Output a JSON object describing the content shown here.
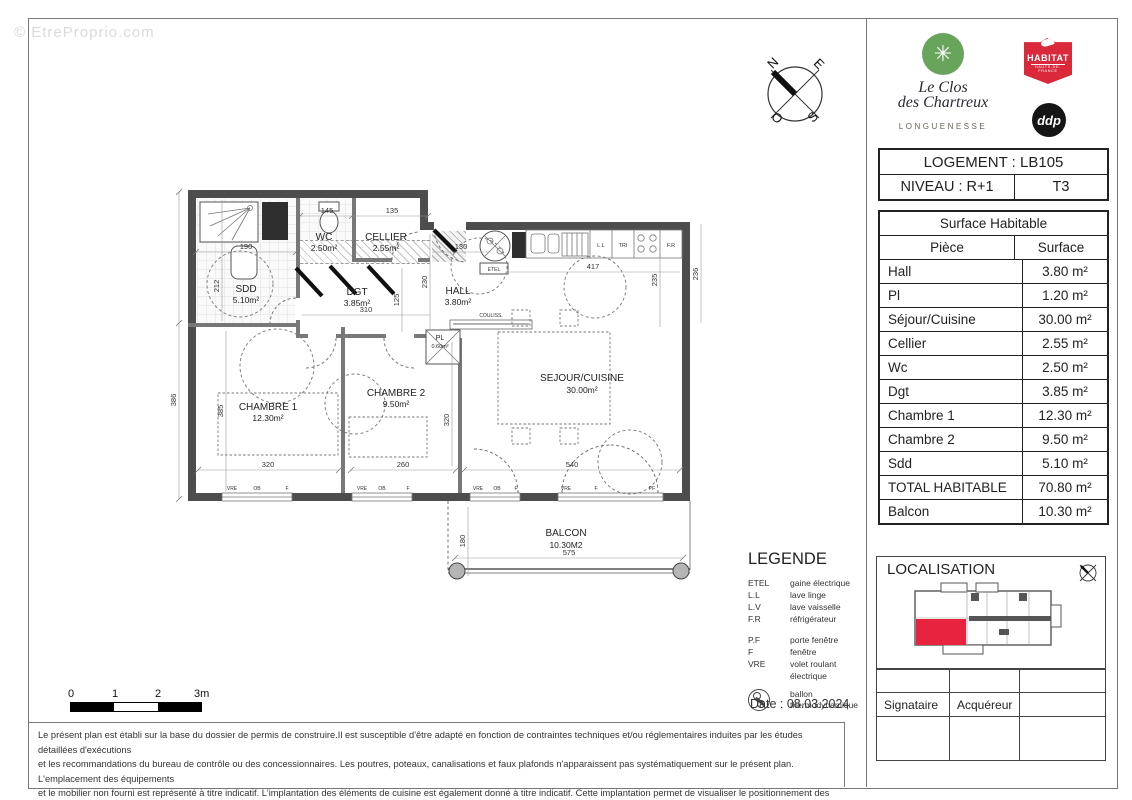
{
  "watermark": "© EtreProprio.com",
  "branding": {
    "project_name_line1": "Le Clos",
    "project_name_line2": "des Chartreux",
    "city": "LONGUENESSE",
    "logo_flower_glyph": "✳",
    "habitat_logo_text": "HABITAT",
    "habitat_logo_subtext": "HAUTS-DE-FRANCE",
    "ddp_logo_text": "ddp",
    "brand_green": "#69a45c",
    "brand_red": "#d9293b"
  },
  "compass": {
    "n": "N",
    "e": "E",
    "o": "O",
    "s": "S"
  },
  "unit_info": {
    "logement_label": "LOGEMENT : LB105",
    "niveau_label": "NIVEAU : R+1",
    "type_label": "T3"
  },
  "surface_table": {
    "title": "Surface Habitable",
    "col_piece": "Pièce",
    "col_surface": "Surface",
    "rows": [
      {
        "piece": "Hall",
        "surface": "3.80 m²"
      },
      {
        "piece": "Pl",
        "surface": "1.20 m²"
      },
      {
        "piece": "Séjour/Cuisine",
        "surface": "30.00 m²"
      },
      {
        "piece": "Cellier",
        "surface": "2.55 m²"
      },
      {
        "piece": "Wc",
        "surface": "2.50 m²"
      },
      {
        "piece": "Dgt",
        "surface": "3.85 m²"
      },
      {
        "piece": "Chambre 1",
        "surface": "12.30 m²"
      },
      {
        "piece": "Chambre 2",
        "surface": "9.50 m²"
      },
      {
        "piece": "Sdd",
        "surface": "5.10 m²"
      },
      {
        "piece": "TOTAL HABITABLE",
        "surface": "70.80 m²"
      },
      {
        "piece": "Balcon",
        "surface": "10.30 m²"
      }
    ]
  },
  "plan": {
    "rooms": [
      {
        "name": "SDD",
        "area": "5.10m²"
      },
      {
        "name": "WC",
        "area": "2.50m²"
      },
      {
        "name": "CELLIER",
        "area": "2.55m²"
      },
      {
        "name": "DGT",
        "area": "3.85m²"
      },
      {
        "name": "HALL",
        "area": "3.80m²"
      },
      {
        "name": "PL",
        "area": "0.60m²"
      },
      {
        "name": "CHAMBRE 1",
        "area": "12.30m²"
      },
      {
        "name": "CHAMBRE 2",
        "area": "9.50m²"
      },
      {
        "name": "SEJOUR/CUISINE",
        "area": "30.00m²"
      },
      {
        "name": "BALCON",
        "area": "10.30M2"
      }
    ],
    "dims": [
      "190",
      "212",
      "145",
      "135",
      "130",
      "417",
      "310",
      "230",
      "125",
      "386",
      "385",
      "320",
      "260",
      "320",
      "540",
      "235",
      "236",
      "575",
      "180"
    ],
    "appliances": [
      "L.L",
      "TRI",
      "F.R"
    ],
    "annotations": {
      "etel": "ETEL",
      "couliss": "COULISS."
    },
    "window_labels": [
      "VRE",
      "OB",
      "F",
      "VRE",
      "OB",
      "F",
      "VRE",
      "OB",
      "F",
      "VRE",
      "F",
      "PF"
    ]
  },
  "legend": {
    "title": "LEGENDE",
    "items": [
      {
        "abbr": "ETEL",
        "label": "gaine électrique"
      },
      {
        "abbr": "L.L",
        "label": "lave linge"
      },
      {
        "abbr": "L.V",
        "label": "lave vaisselle"
      },
      {
        "abbr": "F.R",
        "label": "réfrigérateur"
      },
      {
        "abbr": "P.F",
        "label": "porte fenêtre"
      },
      {
        "abbr": "F",
        "label": "fenêtre"
      },
      {
        "abbr": "VRE",
        "label": "volet roulant électrique"
      }
    ],
    "ballon_label": "ballon thermodynamique"
  },
  "localisation": {
    "title": "LOCALISATION",
    "unit_color": "#e8233f"
  },
  "scalebar": {
    "labels": [
      "0",
      "1",
      "2",
      "3m"
    ]
  },
  "date_label": "Date : 08.03.2024",
  "signature": {
    "signataire": "Signataire",
    "acquereur": "Acquéreur"
  },
  "disclaimer": {
    "lines": [
      "Le présent plan est établi sur la base du dossier de permis de construire.Il est susceptible d'être adapté en fonction de contraintes techniques et/ou réglementaires induites par les études détaillées d'exécutions",
      "et les recommandations du bureau de contrôle ou des concessionnaires. Les poutres, poteaux, canalisations et faux plafonds n'apparaissent pas systématiquement sur le présent plan. L'emplacement des équipements",
      "et le mobilier non fourni est représenté à titre indicatif. L'implantation des éléments de cuisine est également donné à titre indicatif. Cette implantation permet de visualiser le positionnement des points électriques,",
      "des arrivées et des évacuations d'eau à la livraison du logement. Les balcons, terrasses, loggias et jardins sont à jouissance privative."
    ]
  }
}
